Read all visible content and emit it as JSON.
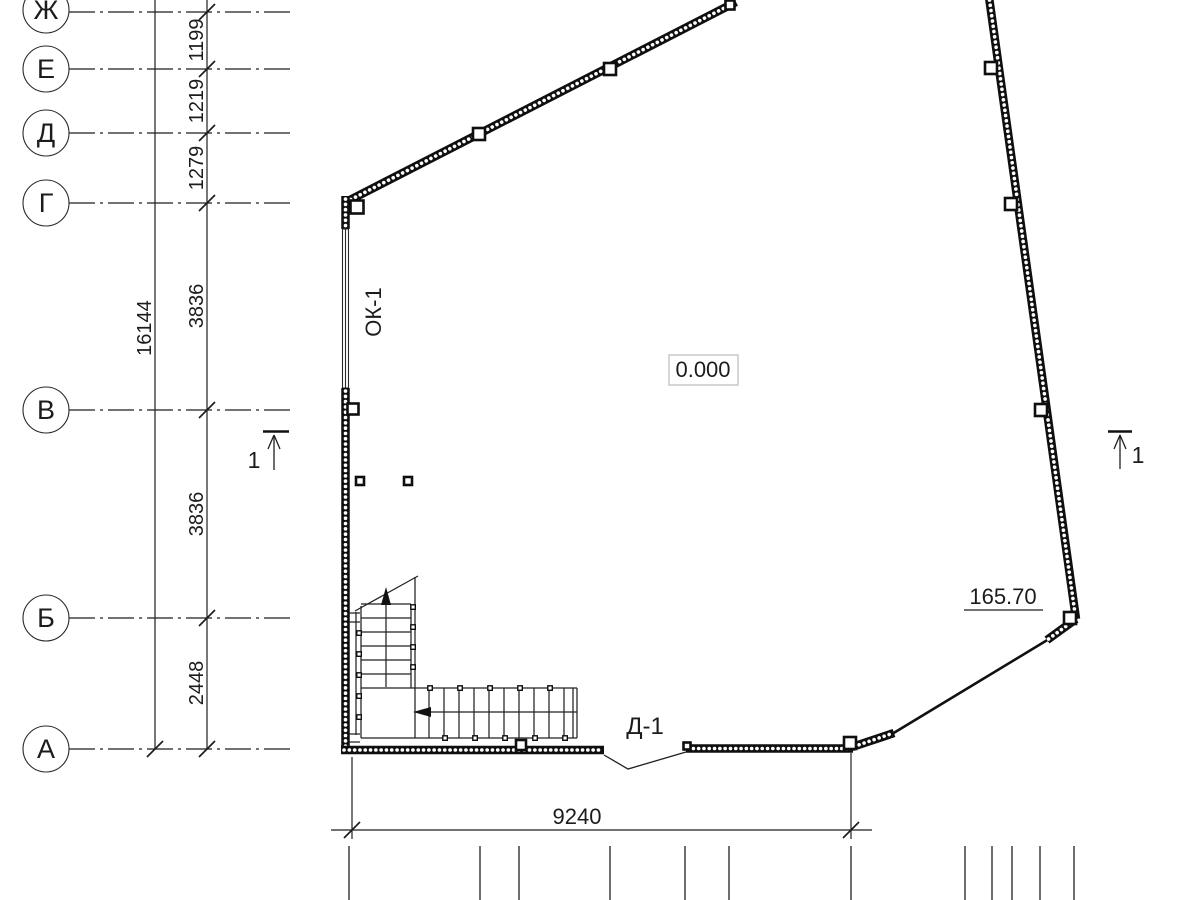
{
  "plan": {
    "axes": [
      {
        "label": "Ж"
      },
      {
        "label": "Е"
      },
      {
        "label": "Д"
      },
      {
        "label": "Г"
      },
      {
        "label": "В"
      },
      {
        "label": "Б"
      },
      {
        "label": "А"
      }
    ],
    "left_dim_chain": [
      "1199",
      "1219",
      "1279",
      "3836",
      "3836",
      "2448"
    ],
    "left_dim_total": "16144",
    "bottom_dim": "9240",
    "window_mark": "ОК-1",
    "door_mark": "Д-1",
    "level_mark": "0.000",
    "elevation_mark": "165.70",
    "section_mark_left": "1",
    "section_mark_right": "1"
  }
}
